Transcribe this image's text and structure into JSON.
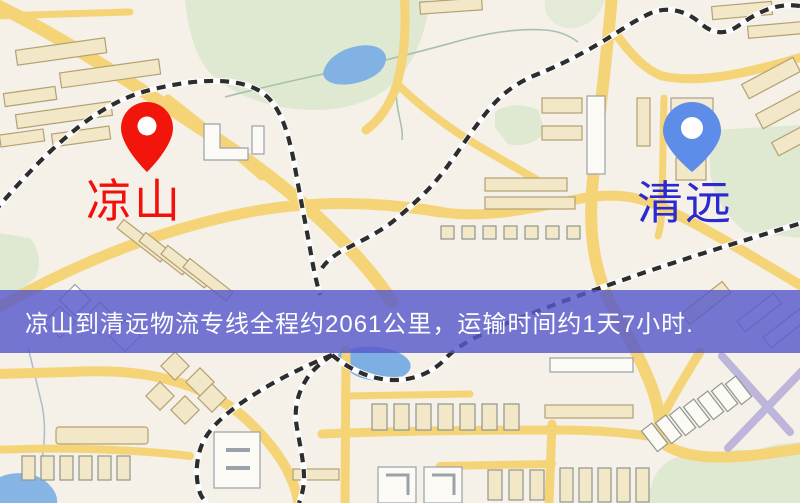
{
  "banner": {
    "text": "凉山到清远物流专线全程约2061公里，运输时间约1天7小时.",
    "text_color": "#ffffff",
    "background_color": "#5759cb"
  },
  "route": {
    "from": "凉山",
    "to": "清远",
    "distance_text": "全程约2061公里",
    "duration_text": "运输时间约1天7小时"
  },
  "markers": {
    "origin": {
      "label": "凉山",
      "pin_color": "#f2150c",
      "label_color": "#f2100a"
    },
    "destination": {
      "label": "清远",
      "pin_color": "#5d8de9",
      "label_color": "#2a2ace"
    }
  },
  "map_colors": {
    "land": "#f5f0e8",
    "road": "#f5d478",
    "road_minor": "#f6d97f",
    "building": "#f2e7c6",
    "building_border": "#b3a174",
    "building_white": "#fbfaf5",
    "park": "#dfe9d2",
    "water": "#82b2e3",
    "railway_dash": "#2d2d2d",
    "lilac_road": "#beb6da"
  }
}
